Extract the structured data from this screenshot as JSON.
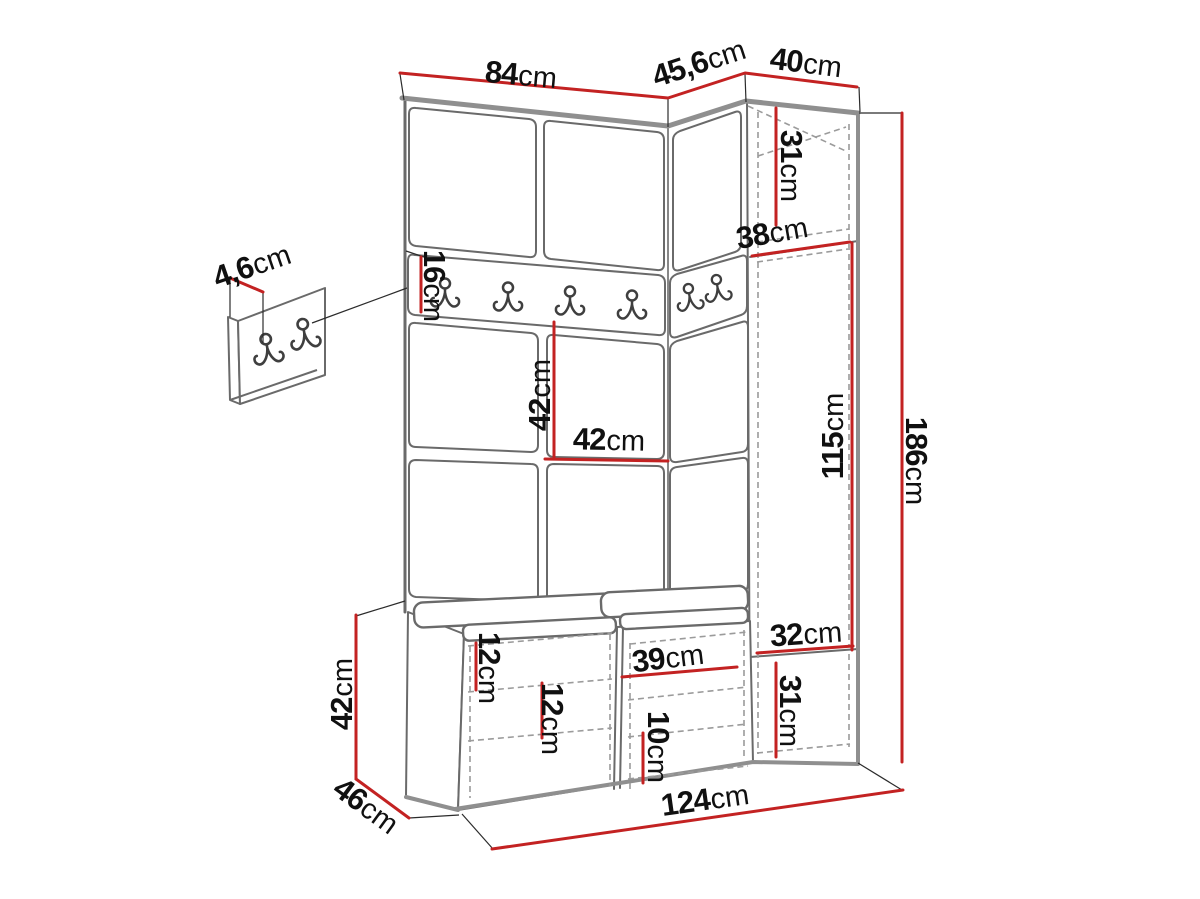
{
  "page": {
    "title": "Hallway wardrobe set dimension diagram",
    "background": "#ffffff"
  },
  "colors": {
    "dimension_line": "#c32222",
    "drawing_line": "#6a6a6a",
    "thick_edge": "#8f8f8f",
    "hidden_line": "#9b9b9b",
    "label_text": "#101010"
  },
  "features": {
    "rail_hook_count": 6,
    "detail_panel_hook_count": 2
  },
  "dimensions": {
    "front_width": {
      "value": "84",
      "unit": "cm"
    },
    "angled_width": {
      "value": "45,6",
      "unit": "cm"
    },
    "column_width": {
      "value": "40",
      "unit": "cm"
    },
    "top_cabinet_height": {
      "value": "31",
      "unit": "cm"
    },
    "corner_depth": {
      "value": "38",
      "unit": "cm"
    },
    "rail_height": {
      "value": "16",
      "unit": "cm"
    },
    "panel_thickness": {
      "value": "4,6",
      "unit": "cm"
    },
    "shelf_height": {
      "value": "42",
      "unit": "cm"
    },
    "shelf_width": {
      "value": "42",
      "unit": "cm"
    },
    "open_section_height": {
      "value": "115",
      "unit": "cm"
    },
    "total_height": {
      "value": "186",
      "unit": "cm"
    },
    "column_inner_width": {
      "value": "32",
      "unit": "cm"
    },
    "bottom_cabinet_height": {
      "value": "31",
      "unit": "cm"
    },
    "bench_gap_a": {
      "value": "12",
      "unit": "cm"
    },
    "bench_gap_b": {
      "value": "12",
      "unit": "cm"
    },
    "bench_inner_width": {
      "value": "39",
      "unit": "cm"
    },
    "bench_gap_c": {
      "value": "10",
      "unit": "cm"
    },
    "bench_height": {
      "value": "42",
      "unit": "cm"
    },
    "bench_depth": {
      "value": "46",
      "unit": "cm"
    },
    "total_width": {
      "value": "124",
      "unit": "cm"
    }
  }
}
